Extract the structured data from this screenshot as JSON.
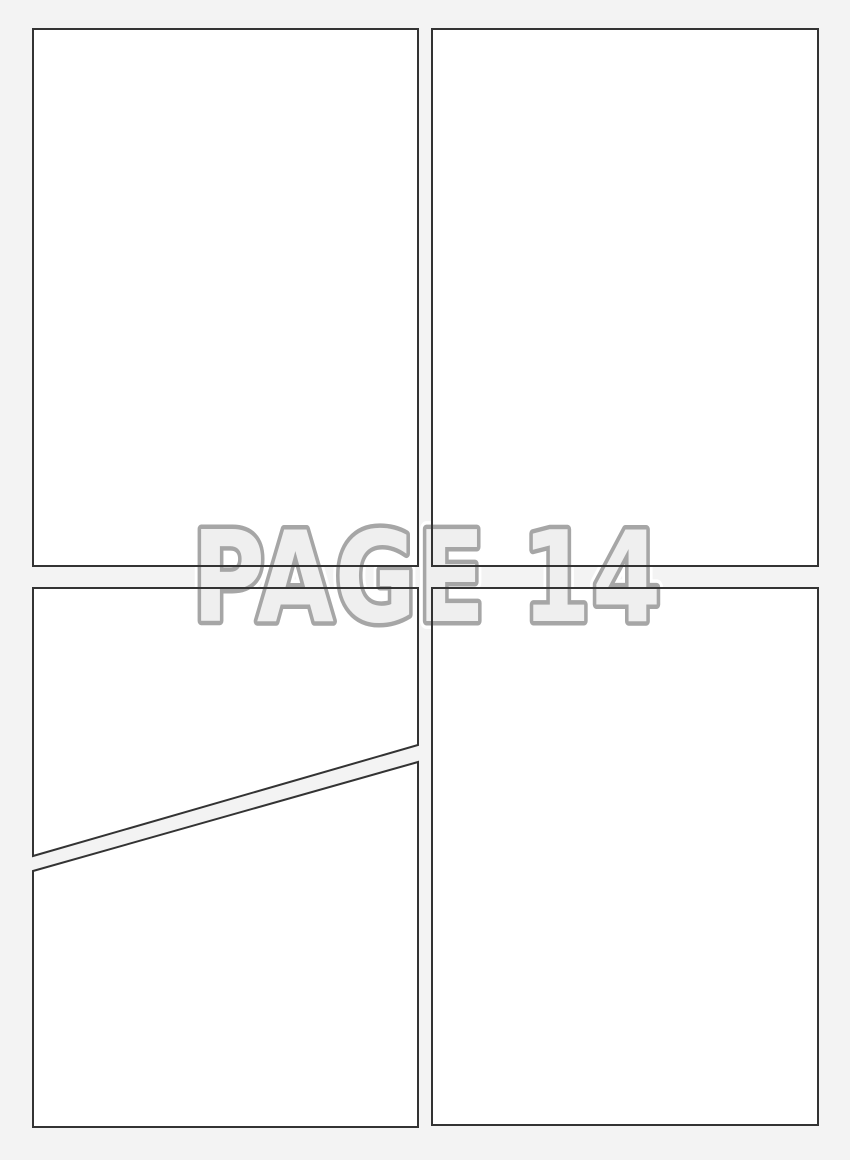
{
  "page": {
    "watermark_text": "PAGE 14"
  },
  "panels": {
    "count": 5,
    "ids": [
      "top-left",
      "top-right",
      "bottom-left-upper",
      "bottom-left-lower",
      "bottom-right"
    ]
  },
  "colors": {
    "page-bg": "#f3f3f3",
    "panel-fill": "#ffffff",
    "panel-border": "#333333",
    "watermark-fill": "#efefef",
    "watermark-stroke": "#a6a6a6",
    "watermark-halo": "#ffffff"
  }
}
